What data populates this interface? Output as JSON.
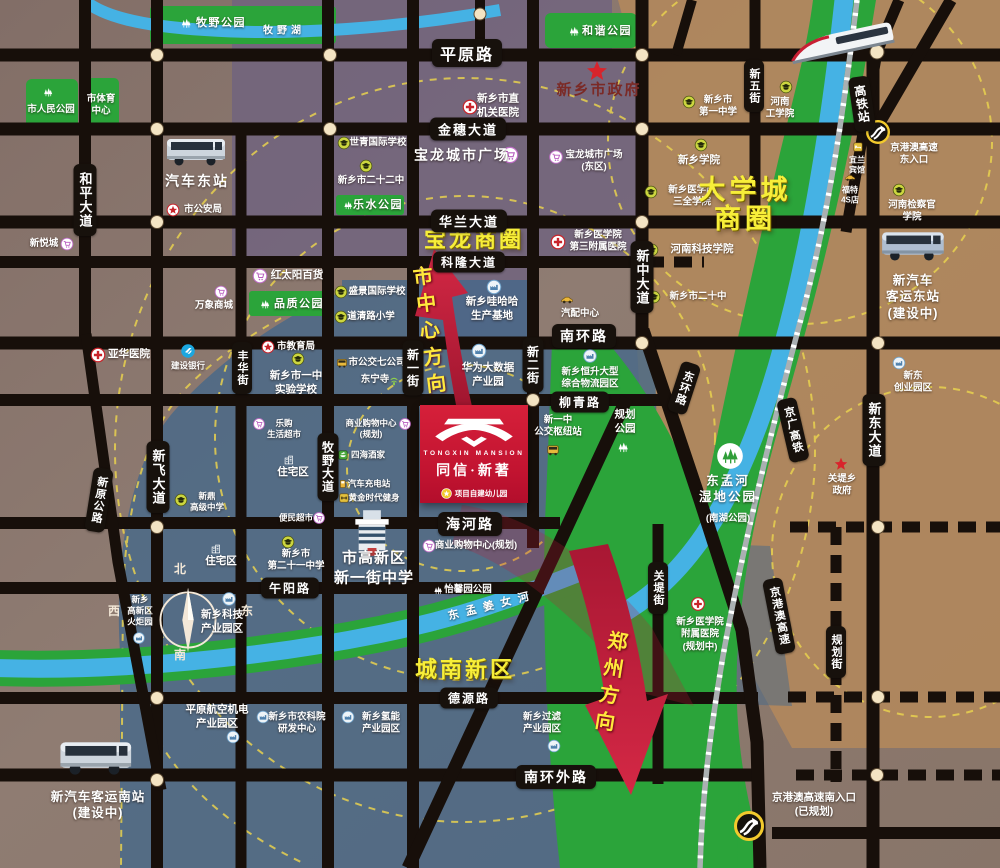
{
  "colors": {
    "road": "#17110c",
    "park_green": "#2ba43a",
    "river_blue": "#45b2e4",
    "zone_blue": "#44688a",
    "zone_purple": "#6f6380",
    "zone_tan": "#b0885c",
    "dashed_ring": "#e8d14f",
    "arrow_red": "#c11b38",
    "logo_red": "#c11330",
    "highlight_yellow": "#f7ee39",
    "dot_cream": "#f4e4c3"
  },
  "project": {
    "name_en": "TONGXIN MANSION",
    "name_cn": "同信·新著",
    "note": "项目自建幼儿园"
  },
  "compass": {
    "n": "北",
    "e": "东",
    "s": "南",
    "w": "西"
  },
  "direction_labels": [
    {
      "id": "to-city-center-label",
      "text": "市中心方向",
      "x": 428,
      "y": 333,
      "rot": -7
    },
    {
      "id": "to-zhengzhou-label",
      "text": "郑州方向",
      "x": 609,
      "y": 684,
      "rot": 9
    }
  ],
  "road_labels": [
    {
      "id": "road-pingyuan",
      "text": "平原路",
      "x": 467,
      "y": 53,
      "o": "h",
      "f": 16
    },
    {
      "id": "road-jinsui",
      "text": "金穗大道",
      "x": 468,
      "y": 129,
      "o": "h"
    },
    {
      "id": "road-hualan",
      "text": "华兰大道",
      "x": 469,
      "y": 221,
      "o": "h"
    },
    {
      "id": "road-kelong",
      "text": "科隆大道",
      "x": 469,
      "y": 262,
      "o": "h",
      "f": 12
    },
    {
      "id": "road-nanhuan",
      "text": "南环路",
      "x": 584,
      "y": 336,
      "o": "h",
      "f": 14
    },
    {
      "id": "road-liuqing",
      "text": "柳青路",
      "x": 580,
      "y": 402,
      "o": "h",
      "f": 12
    },
    {
      "id": "road-haihe",
      "text": "海河路",
      "x": 470,
      "y": 524,
      "o": "h",
      "f": 14
    },
    {
      "id": "road-wuyang",
      "text": "午阳路",
      "x": 290,
      "y": 588,
      "o": "h",
      "f": 12
    },
    {
      "id": "road-deyuan",
      "text": "德源路",
      "x": 469,
      "y": 698,
      "o": "h",
      "f": 12
    },
    {
      "id": "road-nanhuanwai",
      "text": "南环外路",
      "x": 556,
      "y": 777,
      "o": "h",
      "f": 14
    },
    {
      "id": "road-heping",
      "text": "和平大道",
      "x": 85,
      "y": 200,
      "o": "v"
    },
    {
      "id": "road-fenghua",
      "text": "丰华街",
      "x": 242,
      "y": 368,
      "o": "v",
      "f": 11
    },
    {
      "id": "road-muye",
      "text": "牧野大道",
      "x": 328,
      "y": 467,
      "o": "v",
      "f": 12
    },
    {
      "id": "road-xinfei",
      "text": "新飞大道",
      "x": 158,
      "y": 477,
      "o": "v"
    },
    {
      "id": "road-xinyi",
      "text": "新一街",
      "x": 413,
      "y": 368,
      "o": "v",
      "f": 12
    },
    {
      "id": "road-xiner",
      "text": "新二街",
      "x": 533,
      "y": 365,
      "o": "v",
      "f": 12
    },
    {
      "id": "road-xinzhong",
      "text": "新中大道",
      "x": 642,
      "y": 277,
      "o": "v"
    },
    {
      "id": "road-xinwu",
      "text": "新五街",
      "x": 754,
      "y": 86,
      "o": "v",
      "f": 11
    },
    {
      "id": "road-xindong",
      "text": "新东大道",
      "x": 874,
      "y": 430,
      "o": "v"
    },
    {
      "id": "road-guandi",
      "text": "关堤街",
      "x": 658,
      "y": 588,
      "o": "v",
      "f": 11
    },
    {
      "id": "road-guihua",
      "text": "规划街",
      "x": 836,
      "y": 652,
      "o": "v",
      "f": 11
    },
    {
      "id": "hsr-station",
      "text": "高铁站",
      "x": 862,
      "y": 104,
      "o": "v",
      "f": 12,
      "rot": -8
    },
    {
      "id": "road-xinyuan",
      "text": "新原公路",
      "x": 99,
      "y": 500,
      "o": "v",
      "f": 11,
      "rot": 9
    },
    {
      "id": "road-donghuan",
      "text": "东环路",
      "x": 684,
      "y": 388,
      "o": "v",
      "f": 11,
      "rot": 18
    },
    {
      "id": "rail-jingguang",
      "text": "京广高铁",
      "x": 793,
      "y": 430,
      "o": "v",
      "f": 11,
      "rot": -13
    },
    {
      "id": "hwy-jinggangao",
      "text": "京港澳高速",
      "x": 779,
      "y": 616,
      "o": "v",
      "f": 11,
      "rot": -11
    }
  ],
  "pois": [
    {
      "id": "muye-park",
      "x": 221,
      "y": 23,
      "lines": [
        "牧野公园"
      ],
      "icon": "park",
      "ix": 186,
      "iy": 23,
      "is": 15,
      "cls": "park"
    },
    {
      "id": "muye-lake",
      "x": 284,
      "y": 31,
      "lines": [
        "牧野湖"
      ],
      "cls": "lake"
    },
    {
      "id": "renmin-park",
      "x": 51,
      "y": 110,
      "lines": [
        "市人民公园"
      ],
      "icon": "park",
      "ix": 48,
      "iy": 92,
      "is": 14
    },
    {
      "id": "sports-center",
      "x": 101,
      "y": 106,
      "lines": [
        "市体育",
        "中心"
      ]
    },
    {
      "id": "hexie-park",
      "x": 607,
      "y": 31,
      "lines": [
        "和谐公园"
      ],
      "icon": "park",
      "ix": 574,
      "iy": 31,
      "is": 15,
      "cls": "park"
    },
    {
      "id": "city-gov",
      "x": 599,
      "y": 90,
      "lines": [
        "新乡市政府"
      ],
      "icon": "star",
      "ix": 597,
      "iy": 71,
      "is": 22,
      "cls": "gov"
    },
    {
      "id": "shiqing-school",
      "x": 378,
      "y": 143,
      "lines": [
        "世青国际学校"
      ],
      "icon": "school",
      "ix": 344,
      "iy": 143
    },
    {
      "id": "no22-school",
      "x": 371,
      "y": 181,
      "lines": [
        "新乡市二十二中"
      ],
      "icon": "school",
      "ix": 366,
      "iy": 166
    },
    {
      "id": "leshui-park",
      "x": 378,
      "y": 205,
      "lines": [
        "乐水公园"
      ],
      "icon": "park",
      "ix": 348,
      "iy": 205,
      "is": 13,
      "cls": "park"
    },
    {
      "id": "baolong-plaza",
      "x": 462,
      "y": 155,
      "lines": [
        "宝龙城市广场"
      ],
      "icon": "mall",
      "ix": 510,
      "iy": 155,
      "is": 17,
      "cls": "b14"
    },
    {
      "id": "jiguan-hospital",
      "x": 498,
      "y": 106,
      "lines": [
        "新乡市直",
        "机关医院"
      ],
      "icon": "hospital",
      "ix": 470,
      "iy": 107,
      "is": 15,
      "cls": "mid"
    },
    {
      "id": "baolong-east",
      "x": 594,
      "y": 162,
      "lines": [
        "宝龙城市广场",
        "(东区)"
      ],
      "icon": "mall",
      "ix": 556,
      "iy": 157,
      "is": 14
    },
    {
      "id": "sanquan-college",
      "x": 692,
      "y": 197,
      "lines": [
        "新乡医学院",
        "三全学院"
      ],
      "icon": "school",
      "ix": 651,
      "iy": 192
    },
    {
      "id": "xinxiang-college",
      "x": 699,
      "y": 161,
      "lines": [
        "新乡学院"
      ],
      "icon": "school",
      "ix": 701,
      "iy": 145,
      "cls": "mid"
    },
    {
      "id": "no1-middle",
      "x": 718,
      "y": 107,
      "lines": [
        "新乡市",
        "第一中学"
      ],
      "icon": "school",
      "ix": 689,
      "iy": 102
    },
    {
      "id": "henan-tech",
      "x": 780,
      "y": 109,
      "lines": [
        "河南",
        "工学院"
      ],
      "icon": "school",
      "ix": 786,
      "iy": 87
    },
    {
      "id": "keji-college",
      "x": 702,
      "y": 250,
      "lines": [
        "河南科技学院"
      ],
      "icon": "school",
      "ix": 652,
      "iy": 250,
      "cls": "mid"
    },
    {
      "id": "no20-middle",
      "x": 698,
      "y": 297,
      "lines": [
        "新乡市二十中"
      ],
      "icon": "school",
      "ix": 654,
      "iy": 297
    },
    {
      "id": "hongtaiyang",
      "x": 297,
      "y": 276,
      "lines": [
        "红太阳百货"
      ],
      "icon": "mall",
      "ix": 260,
      "iy": 276,
      "is": 15,
      "cls": "mid"
    },
    {
      "id": "pinzhi-park",
      "x": 299,
      "y": 304,
      "lines": [
        "品质公园"
      ],
      "icon": "park",
      "ix": 265,
      "iy": 304,
      "is": 14,
      "cls": "park"
    },
    {
      "id": "shengjing-school",
      "x": 377,
      "y": 292,
      "lines": [
        "盛景国际学校"
      ],
      "icon": "school",
      "ix": 341,
      "iy": 292
    },
    {
      "id": "daoqing-school",
      "x": 371,
      "y": 317,
      "lines": [
        "道清路小学"
      ],
      "icon": "school",
      "ix": 341,
      "iy": 317
    },
    {
      "id": "jiaoyuju",
      "x": 296,
      "y": 347,
      "lines": [
        "市教育局"
      ],
      "icon": "starring",
      "ix": 268,
      "iy": 347
    },
    {
      "id": "yizhong-shiyan",
      "x": 296,
      "y": 383,
      "lines": [
        "新乡市一中",
        "实验学校"
      ],
      "icon": "school",
      "ix": 298,
      "iy": 359,
      "cls": "mid"
    },
    {
      "id": "wanxiang-mall",
      "x": 214,
      "y": 306,
      "lines": [
        "万象商城"
      ],
      "icon": "mall",
      "ix": 221,
      "iy": 292
    },
    {
      "id": "xinyuecheng",
      "x": 44,
      "y": 244,
      "lines": [
        "新悦城"
      ],
      "icon": "mall",
      "ix": 67,
      "iy": 244
    },
    {
      "id": "yahua-hospital",
      "x": 129,
      "y": 355,
      "lines": [
        "亚华医院"
      ],
      "icon": "hospital",
      "ix": 98,
      "iy": 355,
      "is": 15,
      "cls": "mid"
    },
    {
      "id": "ccb-bank",
      "x": 188,
      "y": 366,
      "lines": [
        "建设银行"
      ],
      "icon": "bank",
      "ix": 188,
      "iy": 351,
      "is": 15,
      "cls": "small"
    },
    {
      "id": "qiche-dongzhan",
      "x": 197,
      "y": 181,
      "lines": [
        "汽车东站"
      ],
      "cls": "b14"
    },
    {
      "id": "gonganju",
      "x": 203,
      "y": 210,
      "lines": [
        "市公安局"
      ],
      "icon": "starring",
      "ix": 173,
      "iy": 210
    },
    {
      "id": "med3-hospital",
      "x": 598,
      "y": 242,
      "lines": [
        "新乡医学院",
        "第三附属医院"
      ],
      "icon": "hospital",
      "ix": 558,
      "iy": 242,
      "is": 15
    },
    {
      "id": "wahaha",
      "x": 492,
      "y": 309,
      "lines": [
        "新乡哇哈哈",
        "生产基地"
      ],
      "icon": "industry",
      "ix": 494,
      "iy": 287,
      "is": 15,
      "cls": "mid"
    },
    {
      "id": "qipei-center",
      "x": 580,
      "y": 314,
      "lines": [
        "汽配中心"
      ],
      "icon": "car",
      "ix": 567,
      "iy": 300,
      "is": 15
    },
    {
      "id": "huawei",
      "x": 488,
      "y": 375,
      "lines": [
        "华为大数据",
        "产业园"
      ],
      "icon": "industry",
      "ix": 479,
      "iy": 351,
      "is": 15,
      "cls": "mid"
    },
    {
      "id": "bus7-company",
      "x": 377,
      "y": 363,
      "lines": [
        "市公交七公司"
      ],
      "icon": "bus",
      "ix": 342,
      "iy": 363
    },
    {
      "id": "dongning-temple",
      "x": 375,
      "y": 380,
      "lines": [
        "东宁寺"
      ],
      "icon": "temple",
      "ix": 394,
      "iy": 381
    },
    {
      "id": "hengsheng-logistics",
      "x": 590,
      "y": 379,
      "lines": [
        "新乡恒升大型",
        "综合物流园区"
      ],
      "icon": "industry",
      "ix": 590,
      "iy": 356,
      "is": 14
    },
    {
      "id": "guihua-park",
      "x": 625,
      "y": 422,
      "lines": [
        "规划",
        "公园"
      ],
      "icon": "park",
      "ix": 623,
      "iy": 447,
      "is": 16,
      "cls": "mid"
    },
    {
      "id": "yizhong-hub",
      "x": 558,
      "y": 427,
      "lines": [
        "新一中",
        "公交枢纽站"
      ],
      "icon": "bus",
      "ix": 553,
      "iy": 450,
      "is": 15
    },
    {
      "id": "wetland-park",
      "x": 728,
      "y": 489,
      "lines": [
        "东孟河",
        "湿地公园"
      ],
      "icon": "wetland",
      "ix": 730,
      "iy": 456,
      "is": 27,
      "cls": "wet"
    },
    {
      "id": "wetland-sub",
      "x": 728,
      "y": 519,
      "lines": [
        "(南湖公园)"
      ]
    },
    {
      "id": "dongmengjiangnv-river",
      "x": 492,
      "y": 606,
      "lines": [
        "东孟姜女河"
      ],
      "cls": "river",
      "rot": -14
    },
    {
      "id": "guandi-gov",
      "x": 842,
      "y": 486,
      "lines": [
        "关堤乡",
        "政府"
      ],
      "icon": "star",
      "ix": 841,
      "iy": 464,
      "is": 14
    },
    {
      "id": "affil-hospital",
      "x": 700,
      "y": 635,
      "lines": [
        "新乡医学院",
        "附属医院",
        "(规划中)"
      ],
      "icon": "hospital",
      "ix": 698,
      "iy": 604,
      "is": 14
    },
    {
      "id": "shangye-upper",
      "x": 371,
      "y": 429,
      "lines": [
        "商业购物中心",
        "(规划)"
      ],
      "icon": "mall",
      "ix": 405,
      "iy": 424,
      "is": 12,
      "cls": "small"
    },
    {
      "id": "sihai-restaurant",
      "x": 368,
      "y": 455,
      "lines": [
        "四海酒家"
      ],
      "icon": "food",
      "ix": 343,
      "iy": 455,
      "is": 12,
      "cls": "small"
    },
    {
      "id": "charge-station",
      "x": 369,
      "y": 484,
      "lines": [
        "汽车充电站"
      ],
      "icon": "fuel",
      "ix": 344,
      "iy": 484,
      "is": 12,
      "cls": "small"
    },
    {
      "id": "golden-gym",
      "x": 374,
      "y": 498,
      "lines": [
        "黄金时代健身"
      ],
      "icon": "gym",
      "ix": 344,
      "iy": 498,
      "is": 12,
      "cls": "small"
    },
    {
      "id": "bianmin-market",
      "x": 296,
      "y": 518,
      "lines": [
        "便民超市"
      ],
      "icon": "mall",
      "ix": 319,
      "iy": 518,
      "is": 12,
      "cls": "small"
    },
    {
      "id": "legou-market",
      "x": 284,
      "y": 429,
      "lines": [
        "乐购",
        "生活超市"
      ],
      "icon": "mall",
      "ix": 259,
      "iy": 424,
      "is": 12,
      "cls": "small"
    },
    {
      "id": "zhuzhai-north",
      "x": 293,
      "y": 473,
      "lines": [
        "住宅区"
      ],
      "icon": "home",
      "ix": 289,
      "iy": 460,
      "is": 13,
      "cls": "mid"
    },
    {
      "id": "zhuzhai-south",
      "x": 221,
      "y": 562,
      "lines": [
        "住宅区"
      ],
      "icon": "home",
      "ix": 216,
      "iy": 549,
      "is": 13,
      "cls": "mid"
    },
    {
      "id": "xinding-school",
      "x": 207,
      "y": 502,
      "lines": [
        "新鼎",
        "高级中学"
      ],
      "icon": "school",
      "ix": 181,
      "iy": 500,
      "cls": "small"
    },
    {
      "id": "no21-school",
      "x": 296,
      "y": 561,
      "lines": [
        "新乡市",
        "第二十一中学"
      ],
      "icon": "school",
      "ix": 288,
      "iy": 542
    },
    {
      "id": "gaoxin-school",
      "x": 374,
      "y": 568,
      "lines": [
        "市高新区",
        "新一街中学"
      ],
      "cls": "b15"
    },
    {
      "id": "shangye-haihe",
      "x": 476,
      "y": 546,
      "lines": [
        "商业购物中心(规划)"
      ],
      "icon": "mall",
      "ix": 429,
      "iy": 546,
      "is": 13
    },
    {
      "id": "yixin-park",
      "x": 468,
      "y": 590,
      "lines": [
        "怡馨园公园"
      ],
      "icon": "park",
      "ix": 438,
      "iy": 590,
      "is": 13
    },
    {
      "id": "keji-park",
      "x": 222,
      "y": 622,
      "lines": [
        "新乡科技",
        "产业园区"
      ],
      "icon": "industry",
      "ix": 229,
      "iy": 599,
      "is": 14,
      "cls": "mid"
    },
    {
      "id": "huoju-park",
      "x": 140,
      "y": 611,
      "lines": [
        "新乡",
        "高新区",
        "火炬园"
      ],
      "icon": "industry",
      "ix": 139,
      "iy": 638,
      "is": 12,
      "cls": "small"
    },
    {
      "id": "hangkong-park",
      "x": 217,
      "y": 717,
      "lines": [
        "平原航空机电",
        "产业园区"
      ],
      "icon": "industry",
      "ix": 233,
      "iy": 737,
      "is": 13,
      "cls": "mid"
    },
    {
      "id": "nongkeyuan",
      "x": 297,
      "y": 724,
      "lines": [
        "新乡市农科院",
        "研发中心"
      ],
      "icon": "industry",
      "ix": 263,
      "iy": 717,
      "is": 13
    },
    {
      "id": "qingneng-park",
      "x": 381,
      "y": 724,
      "lines": [
        "新乡氢能",
        "产业园区"
      ],
      "icon": "industry",
      "ix": 348,
      "iy": 717,
      "is": 13
    },
    {
      "id": "guolv-park",
      "x": 542,
      "y": 724,
      "lines": [
        "新乡过滤",
        "产业园区"
      ],
      "icon": "industry",
      "ix": 554,
      "iy": 746,
      "is": 13
    },
    {
      "id": "qiche-nanzhan",
      "x": 98,
      "y": 805,
      "lines": [
        "新汽车客运南站",
        "(建设中)"
      ],
      "cls": "b13"
    },
    {
      "id": "qiche-dongzhan-new",
      "x": 913,
      "y": 297,
      "lines": [
        "新汽车",
        "客运东站",
        "(建设中)"
      ],
      "cls": "b13"
    },
    {
      "id": "xindong-chuangye",
      "x": 913,
      "y": 383,
      "lines": [
        "新东",
        "创业园区"
      ],
      "icon": "industry",
      "ix": 899,
      "iy": 363,
      "is": 13
    },
    {
      "id": "jianchaguan-college",
      "x": 912,
      "y": 212,
      "lines": [
        "河南检察官",
        "学院"
      ],
      "icon": "school",
      "ix": 899,
      "iy": 190
    },
    {
      "id": "yilan-hotel",
      "x": 857,
      "y": 166,
      "lines": [
        "宜兰",
        "宾馆"
      ],
      "icon": "hotel",
      "ix": 858,
      "iy": 147,
      "is": 12,
      "cls": "tiny"
    },
    {
      "id": "ford-4s",
      "x": 850,
      "y": 196,
      "lines": [
        "福特",
        "4S店"
      ],
      "icon": "car",
      "ix": 850,
      "iy": 178,
      "is": 13,
      "cls": "tiny"
    },
    {
      "id": "hwy-east-entry",
      "x": 914,
      "y": 155,
      "lines": [
        "京港澳高速",
        "东入口"
      ],
      "icon": "highway",
      "ix": 878,
      "iy": 132,
      "is": 24
    },
    {
      "id": "hwy-south-entry",
      "x": 814,
      "y": 805,
      "lines": [
        "京港澳高速南入口",
        "(已规划)"
      ],
      "icon": "highway",
      "ix": 749,
      "iy": 826,
      "is": 30,
      "cls": "mid"
    },
    {
      "id": "daxuecheng-circle",
      "x": 745,
      "y": 205,
      "lines": [
        "大学城",
        "商圈"
      ],
      "cls": "arealg"
    },
    {
      "id": "baolong-circle",
      "x": 474,
      "y": 240,
      "lines": [
        "宝龙商圈"
      ],
      "cls": "area"
    },
    {
      "id": "chengnan-district",
      "x": 465,
      "y": 670,
      "lines": [
        "城南新区"
      ],
      "cls": "area"
    }
  ]
}
